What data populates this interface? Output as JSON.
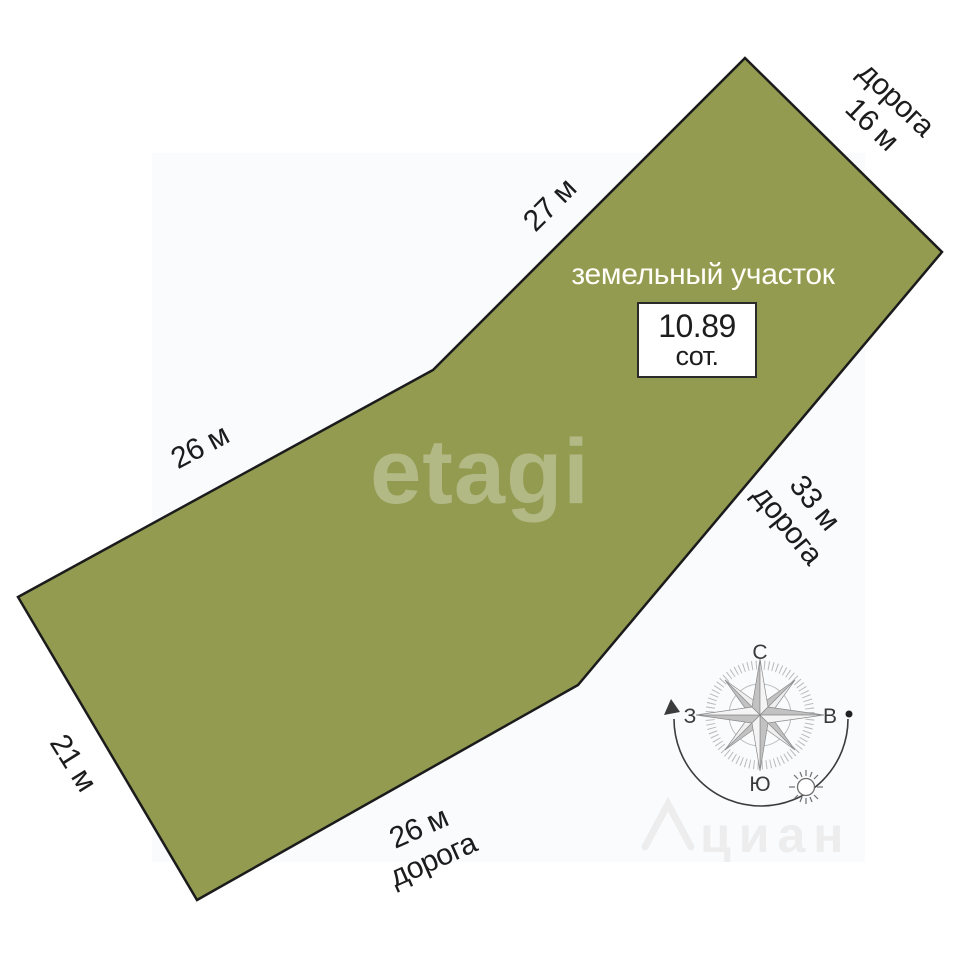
{
  "diagram": {
    "title": "земельный участок",
    "area": {
      "value": "10.89",
      "unit": "сот."
    },
    "polygon_color": "#939B51",
    "sides": {
      "top": {
        "length": "27 м"
      },
      "top_right": {
        "road": "дорога",
        "length": "16 м"
      },
      "upper_left": {
        "length": "26 м"
      },
      "right": {
        "length": "33 м",
        "road": "дорога"
      },
      "lower_left": {
        "length": "21 м"
      },
      "bottom": {
        "length": "26 м",
        "road": "дорога"
      }
    }
  },
  "compass": {
    "north": "С",
    "south": "Ю",
    "west": "З",
    "east": "В"
  },
  "watermarks": {
    "center": "etagi",
    "corner": "циан"
  }
}
